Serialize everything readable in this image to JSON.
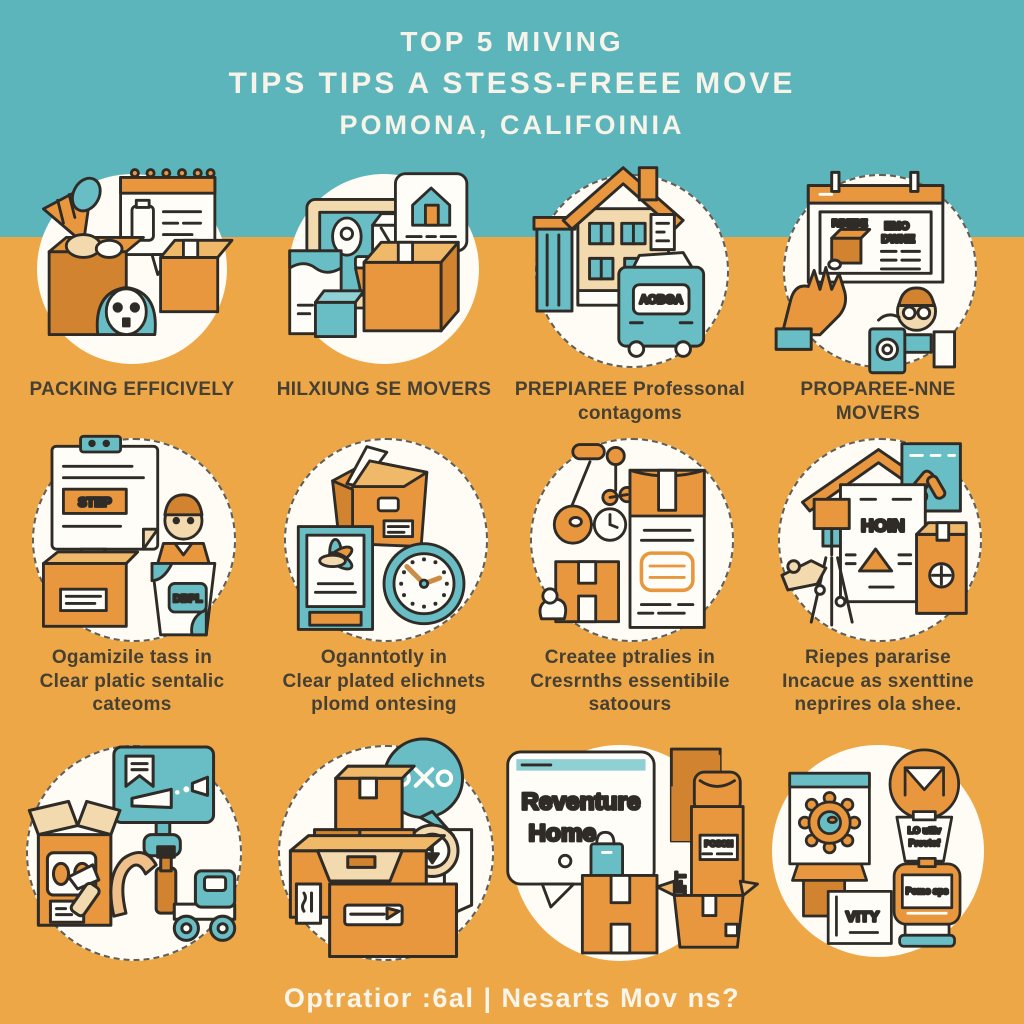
{
  "title": {
    "line1": "TOP 5 MIVING",
    "line2": "TIPS TIPS A STESS-FREEE MOVE",
    "line3": "POMONA, CALIFOINIA"
  },
  "footer": {
    "text": "Optratior :6al | Nesarts Mov ns?"
  },
  "colors": {
    "teal_band": "#5cb5bb",
    "orange_bg": "#eda747",
    "accent_orange": "#e8973f",
    "dark_orange": "#d2832f",
    "tan": "#f3d9ae",
    "teal_accent": "#68bec4",
    "ink": "#2f2b26",
    "caption_text": "#464034",
    "title_text": "#f7f3e9"
  },
  "tiles": [
    {
      "name": "packing-efficively",
      "caption": "PACKING EFFICIVELY"
    },
    {
      "name": "hilxiung-se-movers",
      "caption": "HILXIUNG SE MOVERS"
    },
    {
      "name": "prepare-professional",
      "caption": "PREPIAREE Professonal\ncontagoms",
      "labels": {
        "truck": "AOBGA"
      }
    },
    {
      "name": "propare-nne-movers",
      "caption": "PROPAREE-NNE MOVERS",
      "labels": {
        "card_title": "RBEBE",
        "note1": "EMO",
        "note2": "DWNE"
      }
    },
    {
      "name": "organize-tasks",
      "caption": "Ogamizile tass in\nClear platic sentalic\ncateoms",
      "labels": {
        "step": "STEP",
        "bag": "DBPL"
      }
    },
    {
      "name": "organize-labels",
      "caption": "Oganntotly in\nClear plated elichnets\nplomd ontesing"
    },
    {
      "name": "create-essentials",
      "caption": "Createe ptralies in\nCresrnths essentibile\nsatoours"
    },
    {
      "name": "prepare-supplies",
      "caption": "Riepes pararise\nIncacue as sxenttine\nneprires ola shee.",
      "labels": {
        "doc": "HOIN"
      }
    },
    {
      "name": "unpack-tools",
      "caption": ""
    },
    {
      "name": "stacked-boxes",
      "caption": ""
    },
    {
      "name": "reventure-home",
      "caption": "",
      "labels": {
        "bubble1": "Reventure",
        "bubble2": "Home",
        "box": "POSON",
        "lift": "LIFT"
      }
    },
    {
      "name": "award-gear",
      "caption": "",
      "labels": {
        "cup1": "LO utliv",
        "cup2": "Provtof",
        "stand": "Pomo sps",
        "card": "VITY"
      }
    }
  ]
}
